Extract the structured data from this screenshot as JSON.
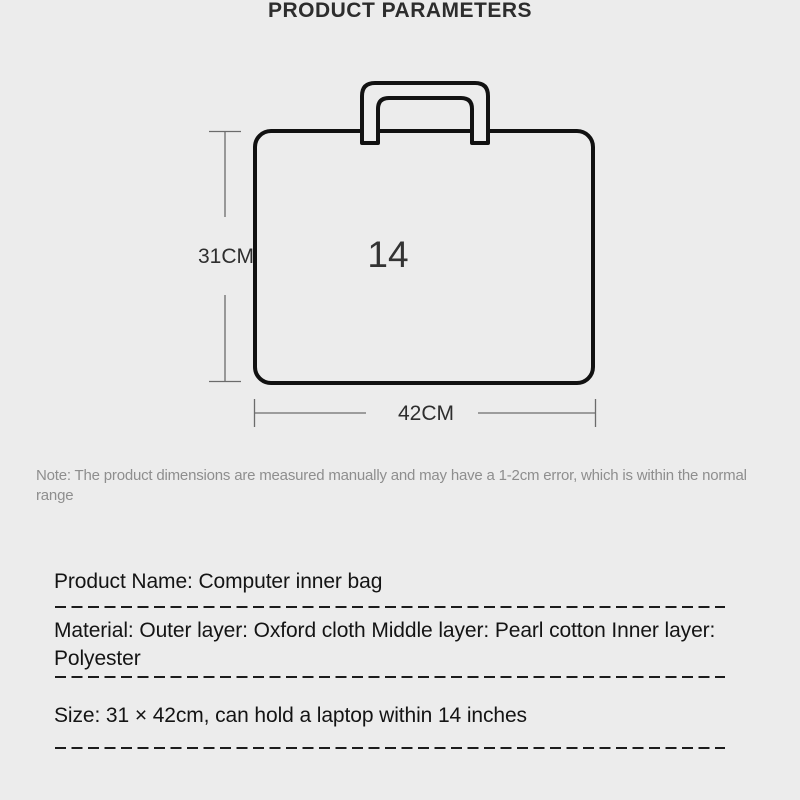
{
  "page": {
    "title": "PRODUCT PARAMETERS",
    "background_color": "#ececec"
  },
  "diagram": {
    "type": "product-dimension-diagram",
    "product_shape": "laptop-bag",
    "bag_inch_label": "14",
    "height_dimension": "31CM",
    "width_dimension": "42CM",
    "outline_color": "#111111",
    "dimension_line_color": "#6b6b6b"
  },
  "note": {
    "text": "Note: The product dimensions are measured manually and may have a 1-2cm error, which is within the normal range"
  },
  "details": {
    "product_name": "Product Name: Computer inner bag",
    "material": "Material: Outer layer: Oxford cloth Middle layer: Pearl cotton Inner layer: Polyester",
    "size": "Size: 31 × 42cm, can hold a laptop within 14 inches"
  }
}
